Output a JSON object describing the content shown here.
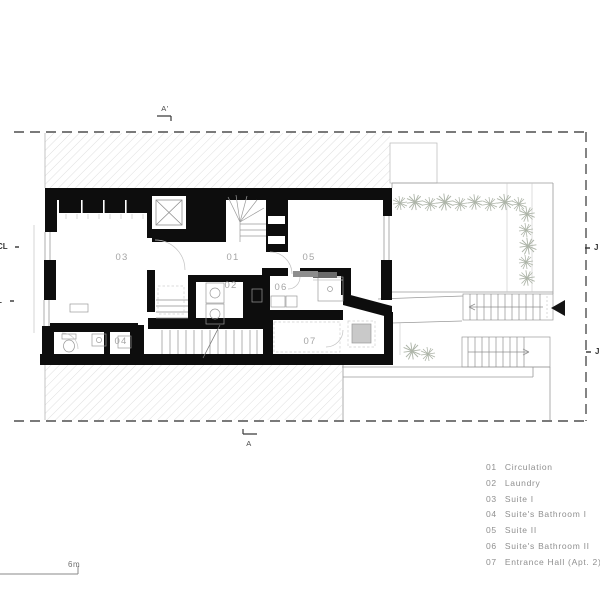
{
  "plan": {
    "section_marker_top": "A'",
    "section_marker_bottom": "A",
    "edge_labels": {
      "left_upper": "CL",
      "left_lower": "L",
      "right_upper": "J",
      "right_lower": "J"
    }
  },
  "legend": {
    "items": [
      {
        "code": "01",
        "name": "Circulation"
      },
      {
        "code": "02",
        "name": "Laundry"
      },
      {
        "code": "03",
        "name": "Suite I"
      },
      {
        "code": "04",
        "name": "Suite's Bathroom I"
      },
      {
        "code": "05",
        "name": "Suite II"
      },
      {
        "code": "06",
        "name": "Suite's Bathroom II"
      },
      {
        "code": "07",
        "name": "Entrance Hall (Apt. 2)"
      }
    ]
  },
  "scale_bar": {
    "label": "6m"
  },
  "colors": {
    "wall": "#0d0d0d",
    "thin_line": "#9a9a9a",
    "hatch": "#dcdcdc",
    "text_gray": "#8f8f8f",
    "vegetation": "#aeb5a9",
    "skylight_fill": "#c9c9c9"
  }
}
